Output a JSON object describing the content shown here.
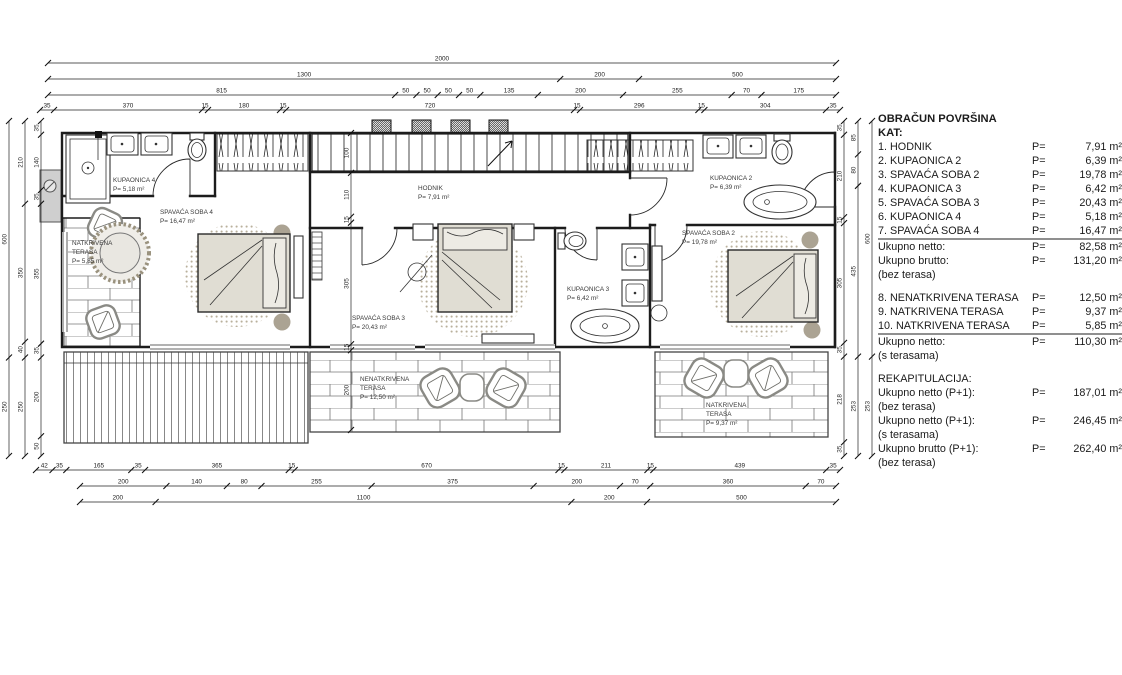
{
  "panel": {
    "title": "OBRAČUN POVRŠINA",
    "subtitle": "KAT:",
    "rows": [
      {
        "label": "1. HODNIK",
        "p": "P=",
        "value": "7,91 m²"
      },
      {
        "label": "2. KUPAONICA 2",
        "p": "P=",
        "value": "6,39 m²"
      },
      {
        "label": "3. SPAVAĆA SOBA 2",
        "p": "P=",
        "value": "19,78 m²"
      },
      {
        "label": "4. KUPAONICA 3",
        "p": "P=",
        "value": "6,42 m²"
      },
      {
        "label": "5. SPAVAĆA SOBA 3",
        "p": "P=",
        "value": "20,43 m²"
      },
      {
        "label": "6. KUPAONICA 4",
        "p": "P=",
        "value": "5,18 m²"
      },
      {
        "label": "7. SPAVAĆA SOBA 4",
        "p": "P=",
        "value": "16,47 m²",
        "rule": true
      },
      {
        "label": "Ukupno netto:",
        "p": "P=",
        "value": "82,58 m²"
      },
      {
        "label": "Ukupno brutto:",
        "p": "P=",
        "value": "131,20 m²"
      },
      {
        "label": "(bez terasa)"
      },
      {
        "gap": true
      },
      {
        "label": "8. NENATKRIVENA TERASA",
        "p": "P=",
        "value": "12,50 m²"
      },
      {
        "label": "9. NATKRIVENA TERASA",
        "p": "P=",
        "value": "9,37 m²"
      },
      {
        "label": "10. NATKRIVENA TERASA",
        "p": "P=",
        "value": "5,85 m²",
        "rule": true
      },
      {
        "label": "Ukupno netto:",
        "p": "P=",
        "value": "110,30 m²"
      },
      {
        "label": "(s terasama)"
      },
      {
        "gap": true
      },
      {
        "label": "REKAPITULACIJA:"
      },
      {
        "label": "Ukupno netto (P+1):",
        "p": "P=",
        "value": "187,01 m²"
      },
      {
        "label": "(bez terasa)"
      },
      {
        "label": "Ukupno netto (P+1):",
        "p": "P=",
        "value": "246,45 m²"
      },
      {
        "label": "(s terasama)"
      },
      {
        "label": "Ukupno brutto (P+1):",
        "p": "P=",
        "value": "262,40 m²"
      },
      {
        "label": "(bez terasa)"
      }
    ]
  },
  "rooms": {
    "kupaonica4": {
      "name": "KUPAONICA 4",
      "area": "P= 5,18 m²"
    },
    "spavaca4": {
      "name": "SPAVAĆA SOBA 4",
      "area": "P= 16,47 m²"
    },
    "terasa_left": {
      "line1": "NATKRIVENA",
      "line2": "TERASA",
      "area": "P= 5,85 m²"
    },
    "hodnik": {
      "name": "HODNIK",
      "area": "P= 7,91 m²"
    },
    "spavaca3": {
      "name": "SPAVAĆA SOBA 3",
      "area": "P= 20,43 m²"
    },
    "nenatkrivena": {
      "line1": "NENATKRIVENA",
      "line2": "TERASA",
      "area": "P= 12,50 m²"
    },
    "kupaonica3": {
      "name": "KUPAONICA 3",
      "area": "P= 6,42 m²"
    },
    "kupaonica2": {
      "name": "KUPAONICA 2",
      "area": "P= 6,39 m²"
    },
    "spavaca2": {
      "name": "SPAVAĆA SOBA 2",
      "area": "P= 19,78 m²"
    },
    "terasa_right": {
      "line1": "NATKRIVENA",
      "line2": "TERASA",
      "area": "P= 9,37 m²"
    }
  },
  "dimensions": {
    "top": [
      [
        2000
      ],
      [
        1300,
        200,
        500
      ],
      [
        815,
        50,
        50,
        50,
        50,
        135,
        200,
        255,
        70,
        175
      ],
      [
        35,
        370,
        15,
        180,
        15,
        720,
        15,
        296,
        15,
        304,
        35
      ]
    ],
    "bottom_upper": [
      42,
      35,
      165,
      35,
      365,
      15,
      670,
      15,
      211,
      15,
      439,
      35
    ],
    "bottom_middle": [
      200,
      140,
      80,
      255,
      375,
      200,
      70,
      360,
      70
    ],
    "bottom_lower": [
      200,
      1100,
      200,
      500
    ],
    "left_outer": [
      600,
      250
    ],
    "left_middle": [
      210,
      350,
      40,
      250
    ],
    "left_inner": [
      35,
      140,
      35,
      355,
      35,
      200,
      50
    ],
    "right_inner": [
      35,
      210,
      15,
      305,
      35,
      218,
      35
    ],
    "right_middle": [
      85,
      80,
      435,
      253
    ],
    "right_outer": [
      600,
      253
    ],
    "interior_vertical": [
      100,
      110,
      15,
      305,
      15,
      200
    ]
  },
  "colors": {
    "wall": "#1c1c1c",
    "label": "#3b3b3b",
    "bed_fill": "#e0ddd3",
    "pillow_fill": "#edebe4",
    "rug_dot": "#b9b09c",
    "nightstand": "#aba393",
    "rule_line": "#8f8f8f",
    "chair": "#8a8a85"
  }
}
